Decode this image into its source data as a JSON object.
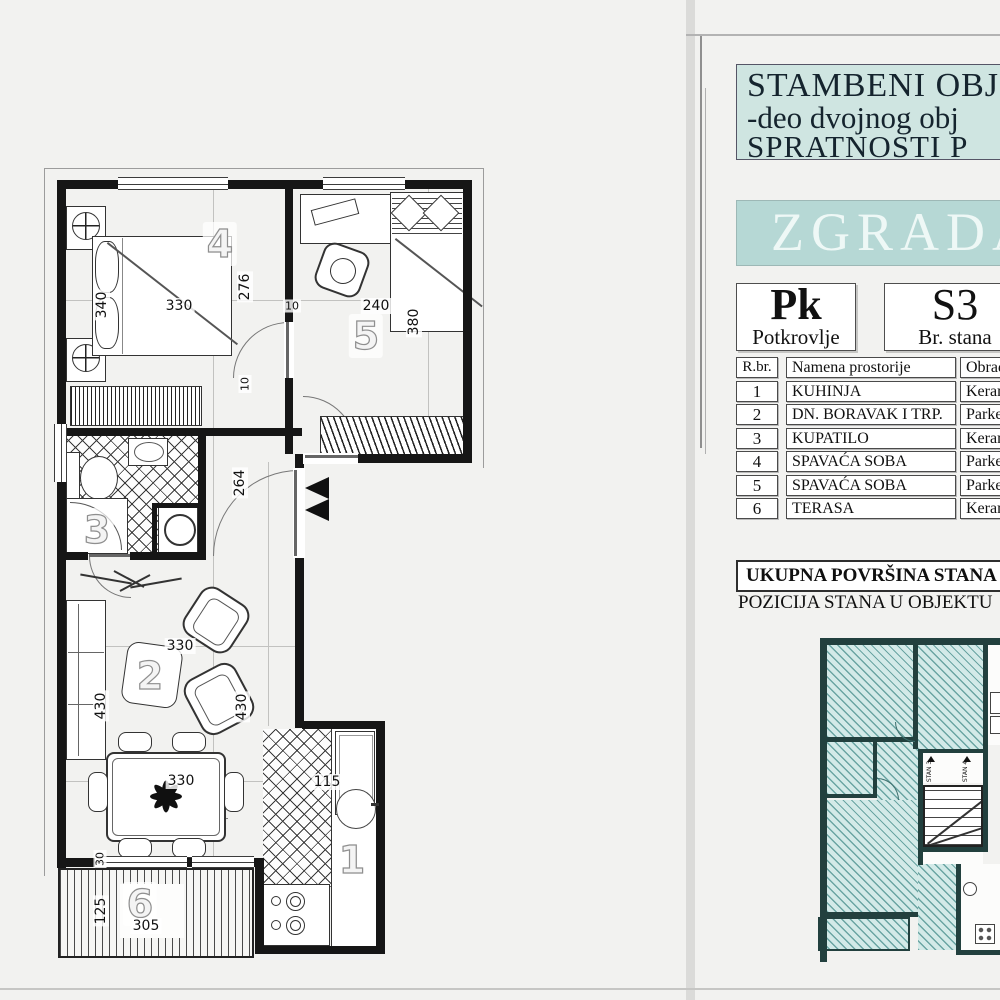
{
  "panel": {
    "title_line1": "STAMBENI OBJ",
    "title_line2": "-deo dvojnog obj",
    "title_line3": "SPRATNOSTI P",
    "building_label": "ZGRADA",
    "floor": {
      "code": "Pk",
      "name": "Potkrovlje"
    },
    "unit": {
      "code": "S3",
      "name": "Br. stana"
    },
    "table": {
      "headers": {
        "num": "R.br.",
        "name": "Namena prostorije",
        "finish": "Obrada"
      },
      "rows": [
        {
          "num": "1",
          "name": "KUHINJA",
          "finish": "Keram"
        },
        {
          "num": "2",
          "name": "DN. BORAVAK I TRP.",
          "finish": "Parket"
        },
        {
          "num": "3",
          "name": "KUPATILO",
          "finish": "Keram"
        },
        {
          "num": "4",
          "name": "SPAVAĆA SOBA",
          "finish": "Parket"
        },
        {
          "num": "5",
          "name": "SPAVAĆA SOBA",
          "finish": "Parket"
        },
        {
          "num": "6",
          "name": "TERASA",
          "finish": "Keram"
        }
      ]
    },
    "total_area_label": "UKUPNA POVRŠINA STANA",
    "position_label": "POZICIJA STANA U OBJEKTU",
    "position_plan": {
      "stan3": "STAN 3",
      "stan4": "STAN 4"
    }
  },
  "plan": {
    "room_numbers": [
      {
        "t": "4",
        "x": 220,
        "y": 244
      },
      {
        "t": "5",
        "x": 366,
        "y": 336
      },
      {
        "t": "3",
        "x": 97,
        "y": 530
      },
      {
        "t": "2",
        "x": 150,
        "y": 676
      },
      {
        "t": "1",
        "x": 352,
        "y": 860
      },
      {
        "t": "6",
        "x": 140,
        "y": 904
      }
    ],
    "dimensions": [
      {
        "t": "330",
        "x": 179,
        "y": 306,
        "r": 0
      },
      {
        "t": "340",
        "x": 102,
        "y": 305,
        "r": 1
      },
      {
        "t": "276",
        "x": 245,
        "y": 287,
        "r": 1
      },
      {
        "t": "10",
        "x": 245,
        "y": 384,
        "r": 1,
        "s": 1
      },
      {
        "t": "10",
        "x": 292,
        "y": 306,
        "r": 0,
        "s": 1
      },
      {
        "t": "240",
        "x": 376,
        "y": 306,
        "r": 0
      },
      {
        "t": "380",
        "x": 414,
        "y": 322,
        "r": 1
      },
      {
        "t": "264",
        "x": 240,
        "y": 483,
        "r": 1
      },
      {
        "t": "330",
        "x": 180,
        "y": 646,
        "r": 0
      },
      {
        "t": "430",
        "x": 101,
        "y": 706,
        "r": 1
      },
      {
        "t": "430",
        "x": 242,
        "y": 707,
        "r": 1
      },
      {
        "t": "330",
        "x": 181,
        "y": 781,
        "r": 0
      },
      {
        "t": "115",
        "x": 327,
        "y": 782,
        "r": 0
      },
      {
        "t": "30",
        "x": 100,
        "y": 859,
        "r": 1,
        "s": 1
      },
      {
        "t": "125",
        "x": 101,
        "y": 911,
        "r": 1
      },
      {
        "t": "305",
        "x": 146,
        "y": 926,
        "r": 0
      }
    ]
  },
  "colors": {
    "teal_box": "#cfe5e1",
    "teal_band": "#b6d8d5",
    "hatch_fill": "#d3eae8",
    "wall": "#161616"
  }
}
